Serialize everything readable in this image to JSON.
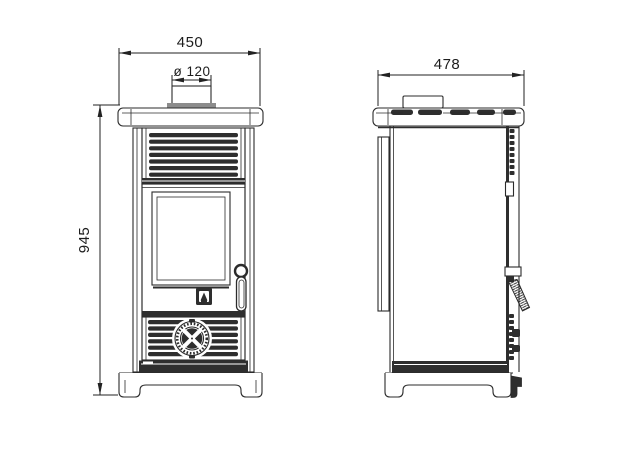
{
  "drawing": {
    "type": "technical-two-view-stove-drawing",
    "front_view": {
      "width_label": "450",
      "flue_diameter_label": "ø 120",
      "height_label": "945"
    },
    "side_view": {
      "depth_label": "478"
    }
  },
  "colors": {
    "line": "#2b2b2b",
    "background": "#ffffff",
    "shadow_fill": "#8c8c8c",
    "dark_fill": "#2e2e2e"
  }
}
